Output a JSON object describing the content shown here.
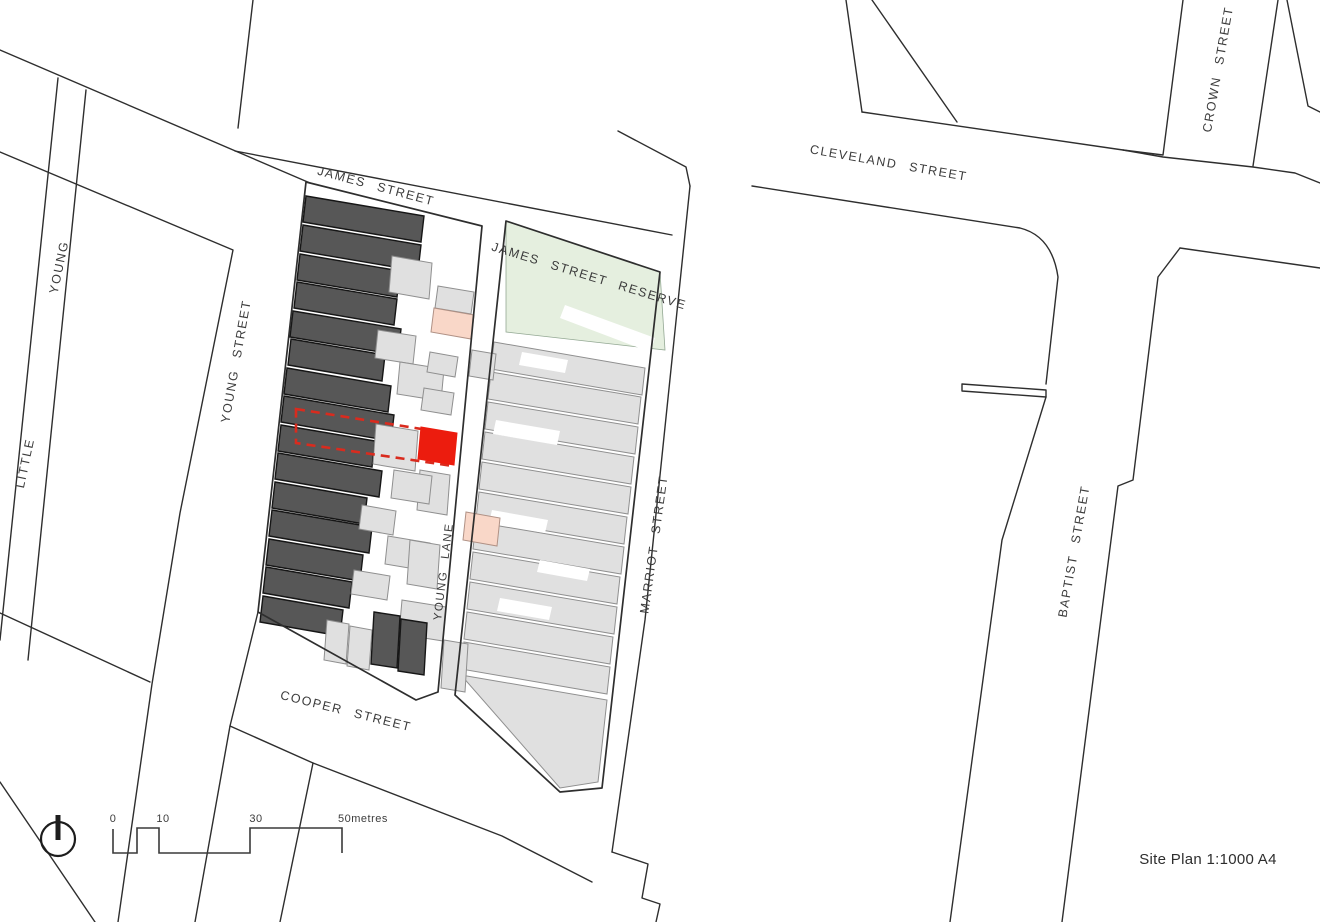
{
  "title": "Site Plan 1:1000 A4",
  "colors": {
    "bg": "#ffffff",
    "line": "#2e2e2e",
    "label": "#3c3c3c",
    "dark": "#575757",
    "darkStroke": "#161616",
    "light": "#e0e0e0",
    "lightStroke": "#8f8f8f",
    "green": "#e5efdf",
    "greenStroke": "#93a893",
    "pink": "#f9d7c8",
    "pinkStroke": "#b09185",
    "red": "#ec1c0e",
    "redLine": "#d92b1e"
  },
  "map": {
    "labels": {
      "james": {
        "text": "JAMES  STREET"
      },
      "cleveland": {
        "text": "CLEVELAND  STREET"
      },
      "crown": {
        "text": "CROWN  STREET"
      },
      "young_upper": {
        "text": "YOUNG"
      },
      "little_lower": {
        "text": "LITTLE"
      },
      "young_street": {
        "text": "YOUNG  STREET"
      },
      "reserve": {
        "text": "JAMES  STREET  RESERVE"
      },
      "marriot": {
        "text": "MARRIOT  STREET"
      },
      "young_lane": {
        "text": "YOUNG  LANE"
      },
      "baptist": {
        "text": "BAPTIST  STREET"
      },
      "cooper": {
        "text": "COOPER  STREET"
      }
    },
    "legend": {
      "site_plan": "Site Plan 1:1000 A4"
    },
    "scale": {
      "t0": "0",
      "t10": "10",
      "t30": "30",
      "t50": "50metres"
    }
  }
}
